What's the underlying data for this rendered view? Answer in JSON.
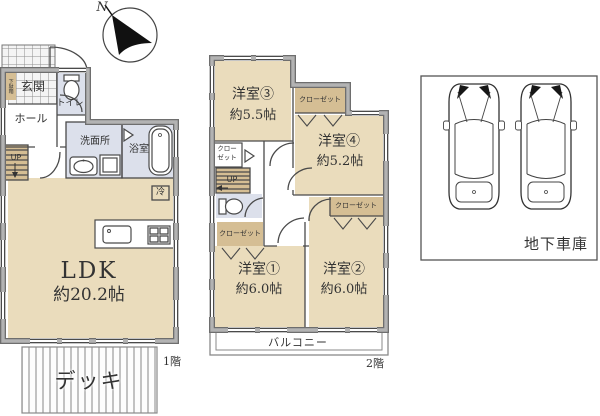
{
  "colors": {
    "room": "#eadcbc",
    "closet": "#d5be94",
    "wet": "#dce0eb",
    "wall_edge": "#6e6e6e",
    "wall_fill": "#b3b3b3",
    "line": "#4a4a4a",
    "text": "#333333"
  },
  "compass": {
    "north_label": "N"
  },
  "floor1": {
    "floor_label": "1階",
    "entrance": "玄関",
    "shoe_cabinet": "下駄箱",
    "hall": "ホール",
    "toilet": "トイレ",
    "washroom": "洗面所",
    "bath": "浴室",
    "stairs_label": "UP",
    "fridge_label": "冷",
    "ldk": {
      "name": "LDK",
      "size": "約20.2帖"
    },
    "deck": "デッキ"
  },
  "floor2": {
    "floor_label": "2階",
    "rooms": [
      {
        "name": "洋室③",
        "size": "約5.5帖"
      },
      {
        "name": "洋室④",
        "size": "約5.2帖"
      },
      {
        "name": "洋室①",
        "size": "約6.0帖"
      },
      {
        "name": "洋室②",
        "size": "約6.0帖"
      }
    ],
    "closet_label": "クローゼット",
    "closet_line1": "クロー",
    "closet_line2": "ゼット",
    "stairs_label": "UP",
    "balcony": "バルコニー"
  },
  "garage": {
    "label": "地下車庫"
  }
}
